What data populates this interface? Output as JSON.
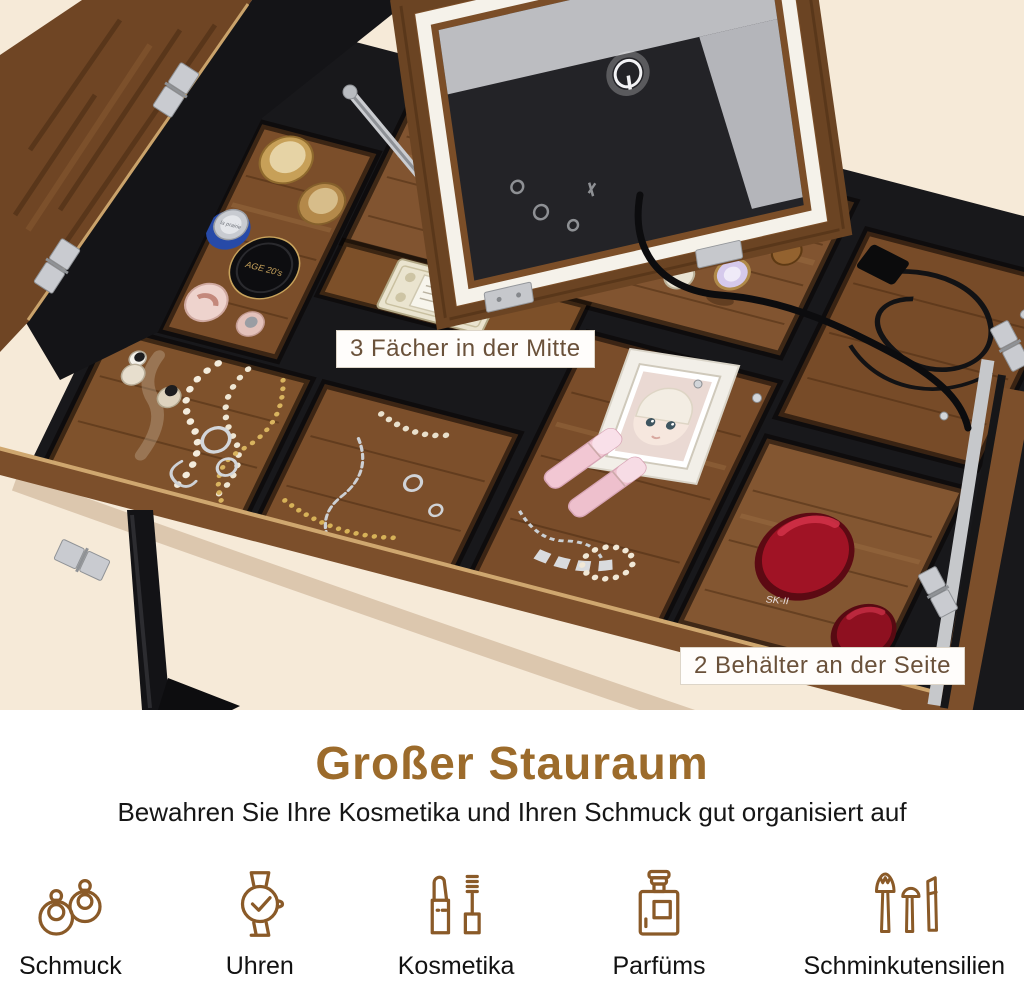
{
  "photo": {
    "annotations": [
      {
        "text": "3 Fächer in der Mitte"
      },
      {
        "text": "2 Behälter an der Seite"
      }
    ],
    "products": {
      "compact_label": "AGE 20's",
      "silver_cap_label": "la prairie",
      "red_jar_label": "SK-II"
    }
  },
  "info": {
    "title": "Großer Stauraum",
    "subtitle": "Bewahren Sie Ihre Kosmetika und Ihren Schmuck gut organisiert auf",
    "features": [
      {
        "icon": "earrings-icon",
        "label": "Schmuck"
      },
      {
        "icon": "watch-icon",
        "label": "Uhren"
      },
      {
        "icon": "cosmetics-icon",
        "label": "Kosmetika"
      },
      {
        "icon": "perfume-icon",
        "label": "Parfüms"
      },
      {
        "icon": "brushes-icon",
        "label": "Schminkutensilien"
      }
    ]
  },
  "colors": {
    "accent_brown": "#9c6b2b",
    "icon_brown": "#8a5a28",
    "background_beige": "#f6ead8",
    "label_text_brown": "#6a513a",
    "wood_brown": "#7a4e2b",
    "table_black": "#18181b",
    "red_jar": "#a01325",
    "led_white": "#f5f2ea"
  }
}
